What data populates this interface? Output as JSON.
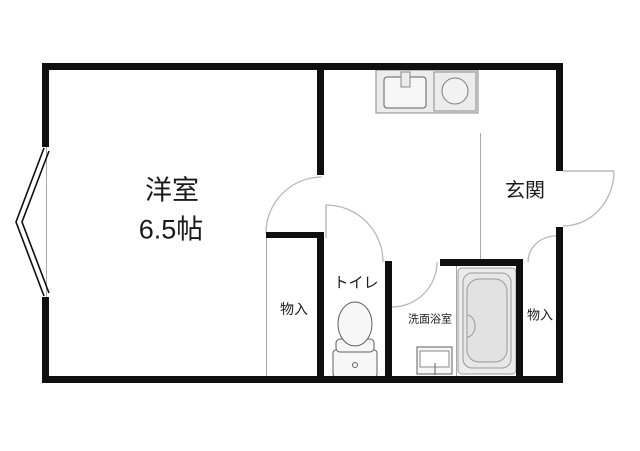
{
  "plan": {
    "rooms": {
      "main_room": {
        "label": "洋室",
        "size": "6.5帖"
      },
      "entrance": {
        "label": "玄関"
      },
      "toilet": {
        "label": "トイレ"
      },
      "washroom_bath": {
        "label": "洗面浴室"
      },
      "storage_main": {
        "label": "物入"
      },
      "storage_entrance": {
        "label": "物入"
      }
    },
    "colors": {
      "background": "#ffffff",
      "wall": "#0f0f0f",
      "thin_line": "#a8a8a8",
      "door_arc": "#b8b8b8",
      "fixture_fill": "#ececec",
      "fixture_stroke": "#8a8a8a"
    }
  }
}
